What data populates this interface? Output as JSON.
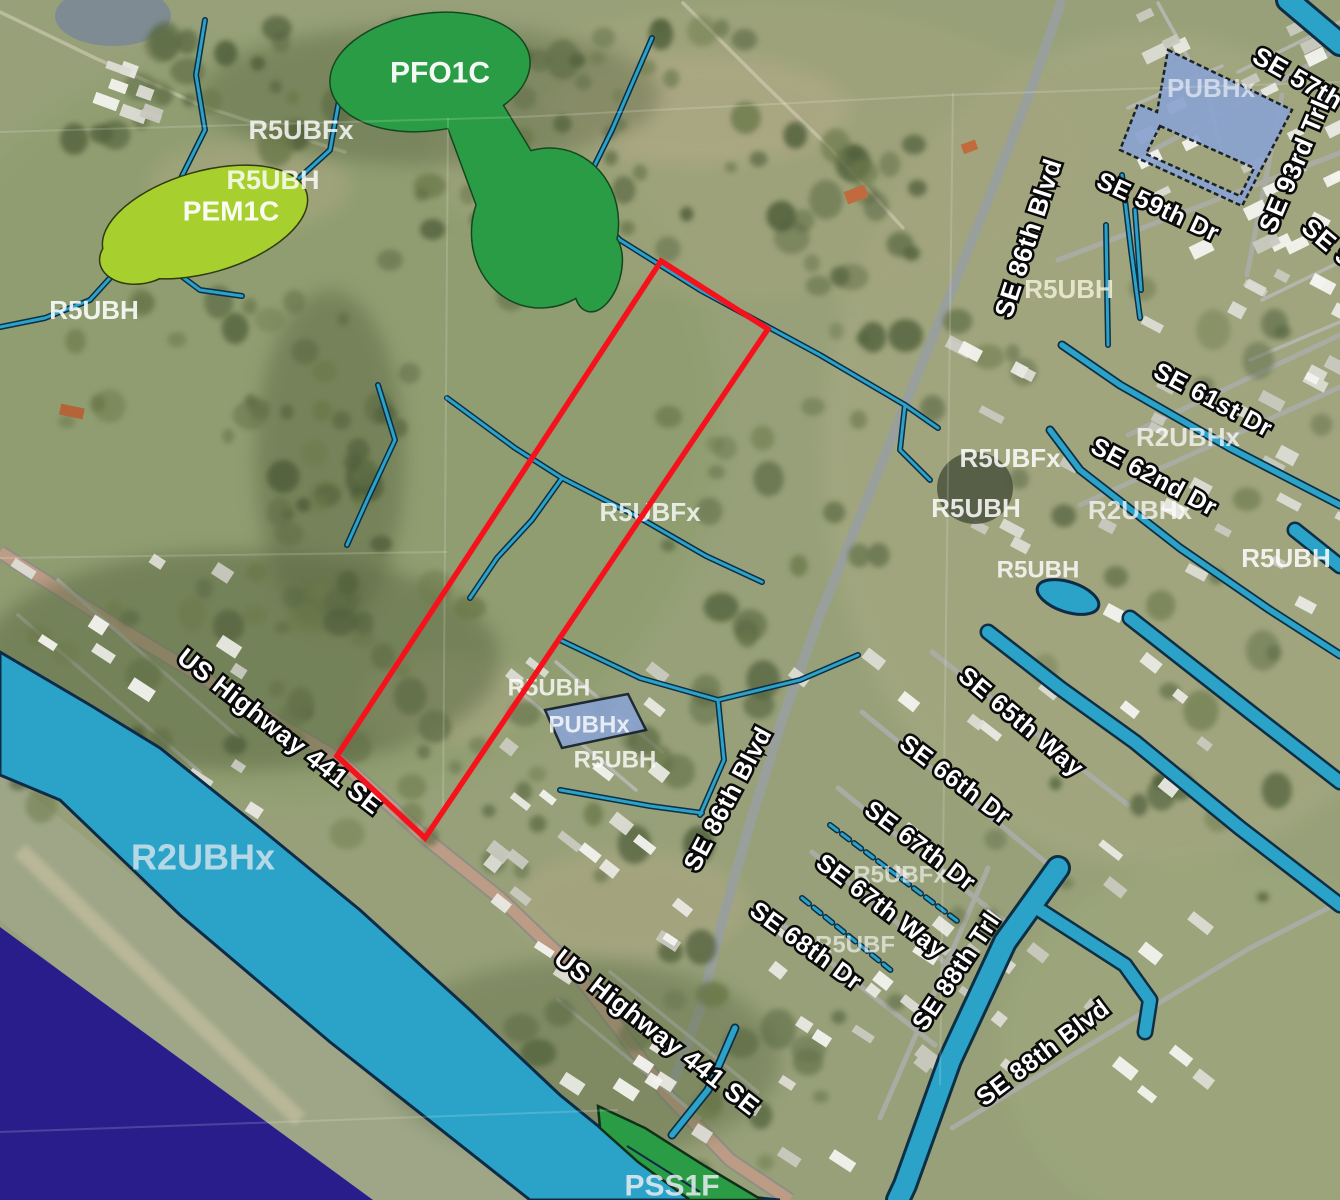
{
  "map": {
    "type": "wetlands-inventory-aerial-map",
    "parcel_outline": {
      "color": "#f5121d",
      "points": [
        [
          661,
          261
        ],
        [
          768,
          329
        ],
        [
          425,
          838
        ],
        [
          337,
          756
        ]
      ]
    },
    "colors": {
      "forested_wetland_green": "#2b9c46",
      "emergent_wetland_green": "#a7d02f",
      "pond_overlay_blue": "#8ba3d0",
      "canal_teal": "#2ba2c8",
      "lake_purple": "#291d8c",
      "parcel_red": "#f5121d"
    },
    "labels": [
      {
        "kind": "wetland",
        "text": "PFO1C",
        "x": 440,
        "y": 73,
        "size": 30,
        "rot": 0,
        "opacity": 0.95,
        "fill": "#ffffff"
      },
      {
        "kind": "wetland",
        "text": "R5UBFx",
        "x": 301,
        "y": 130,
        "size": 27,
        "rot": 0,
        "opacity": 0.82,
        "fill": "#ffffff"
      },
      {
        "kind": "wetland",
        "text": "R5UBH",
        "x": 273,
        "y": 180,
        "size": 27,
        "rot": 0,
        "opacity": 0.82,
        "fill": "#ffffff"
      },
      {
        "kind": "wetland",
        "text": "PEM1C",
        "x": 231,
        "y": 211,
        "size": 28,
        "rot": 0,
        "opacity": 0.95,
        "fill": "#ffffff"
      },
      {
        "kind": "wetland",
        "text": "R5UBH",
        "x": 94,
        "y": 310,
        "size": 26,
        "rot": 0,
        "opacity": 0.88,
        "fill": "#ffffff"
      },
      {
        "kind": "wetland",
        "text": "R5UBFx",
        "x": 650,
        "y": 512,
        "size": 26,
        "rot": 0,
        "opacity": 0.8,
        "fill": "#ffffff"
      },
      {
        "kind": "wetland",
        "text": "R5UBH",
        "x": 549,
        "y": 688,
        "size": 24,
        "rot": 0,
        "opacity": 0.8,
        "fill": "#ffffff"
      },
      {
        "kind": "wetland",
        "text": "PUBHx",
        "x": 589,
        "y": 725,
        "size": 24,
        "rot": 0,
        "opacity": 0.8,
        "fill": "#ffffff"
      },
      {
        "kind": "wetland",
        "text": "R5UBH",
        "x": 615,
        "y": 760,
        "size": 24,
        "rot": 0,
        "opacity": 0.8,
        "fill": "#ffffff"
      },
      {
        "kind": "wetland",
        "text": "R2UBHx",
        "x": 203,
        "y": 857,
        "size": 36,
        "rot": 0,
        "opacity": 0.8,
        "fill": "#d8e6ef"
      },
      {
        "kind": "wetland",
        "text": "PSS1F",
        "x": 672,
        "y": 1186,
        "size": 30,
        "rot": 0,
        "opacity": 0.85,
        "fill": "#e8eef2"
      },
      {
        "kind": "wetland",
        "text": "PUBHx",
        "x": 1211,
        "y": 88,
        "size": 26,
        "rot": 0,
        "opacity": 0.7,
        "fill": "#e9eef6"
      },
      {
        "kind": "wetland",
        "text": "R5UBH",
        "x": 1069,
        "y": 289,
        "size": 26,
        "rot": 0,
        "opacity": 0.82,
        "fill": "#f4f2dd"
      },
      {
        "kind": "wetland",
        "text": "R5UBFx",
        "x": 1010,
        "y": 458,
        "size": 26,
        "rot": 0,
        "opacity": 0.85,
        "fill": "#ffffff"
      },
      {
        "kind": "wetland",
        "text": "R5UBH",
        "x": 976,
        "y": 508,
        "size": 26,
        "rot": 0,
        "opacity": 0.85,
        "fill": "#ffffff"
      },
      {
        "kind": "wetland",
        "text": "R2UBHx",
        "x": 1188,
        "y": 437,
        "size": 26,
        "rot": 0,
        "opacity": 0.72,
        "fill": "#ffffff"
      },
      {
        "kind": "wetland",
        "text": "R2UBHx",
        "x": 1140,
        "y": 510,
        "size": 26,
        "rot": 0,
        "opacity": 0.72,
        "fill": "#ffffff"
      },
      {
        "kind": "wetland",
        "text": "R5UBH",
        "x": 1286,
        "y": 558,
        "size": 26,
        "rot": 0,
        "opacity": 0.85,
        "fill": "#ffffff"
      },
      {
        "kind": "wetland",
        "text": "R5UBH",
        "x": 1038,
        "y": 570,
        "size": 24,
        "rot": 0,
        "opacity": 0.82,
        "fill": "#ffffff"
      },
      {
        "kind": "wetland",
        "text": "R5UBFx",
        "x": 900,
        "y": 875,
        "size": 24,
        "rot": 0,
        "opacity": 0.6,
        "fill": "#ffffff"
      },
      {
        "kind": "wetland",
        "text": "R5UBF",
        "x": 855,
        "y": 945,
        "size": 24,
        "rot": 0,
        "opacity": 0.6,
        "fill": "#ffffff"
      },
      {
        "kind": "street",
        "text": "SE 57th",
        "x": 1298,
        "y": 78,
        "size": 26,
        "rot": 30
      },
      {
        "kind": "street",
        "text": "SE 93rd Trl",
        "x": 1294,
        "y": 166,
        "size": 26,
        "rot": -67
      },
      {
        "kind": "street",
        "text": "SE 59th Dr",
        "x": 1158,
        "y": 207,
        "size": 25,
        "rot": 25
      },
      {
        "kind": "street",
        "text": "SE 86th Blvd",
        "x": 1028,
        "y": 238,
        "size": 26,
        "rot": -72
      },
      {
        "kind": "street",
        "text": "SE 9",
        "x": 1328,
        "y": 242,
        "size": 26,
        "rot": 40
      },
      {
        "kind": "street",
        "text": "SE 61st Dr",
        "x": 1213,
        "y": 400,
        "size": 25,
        "rot": 28
      },
      {
        "kind": "street",
        "text": "SE 62nd Dr",
        "x": 1154,
        "y": 477,
        "size": 25,
        "rot": 28
      },
      {
        "kind": "street",
        "text": "SE 65th Way",
        "x": 1021,
        "y": 722,
        "size": 25,
        "rot": 40
      },
      {
        "kind": "street",
        "text": "SE 66th Dr",
        "x": 955,
        "y": 780,
        "size": 25,
        "rot": 37
      },
      {
        "kind": "street",
        "text": "SE 67th Dr",
        "x": 920,
        "y": 846,
        "size": 25,
        "rot": 37
      },
      {
        "kind": "street",
        "text": "SE 67th Way",
        "x": 881,
        "y": 906,
        "size": 25,
        "rot": 37
      },
      {
        "kind": "street",
        "text": "SE 68th Dr",
        "x": 806,
        "y": 946,
        "size": 25,
        "rot": 36
      },
      {
        "kind": "street",
        "text": "SE 88th Trl",
        "x": 956,
        "y": 972,
        "size": 25,
        "rot": -56
      },
      {
        "kind": "street",
        "text": "SE 88th Blvd",
        "x": 1043,
        "y": 1053,
        "size": 25,
        "rot": -37
      },
      {
        "kind": "street",
        "text": "US Highway 441 SE",
        "x": 280,
        "y": 731,
        "size": 26,
        "rot": 38
      },
      {
        "kind": "street",
        "text": "US Highway 441 SE",
        "x": 657,
        "y": 1032,
        "size": 26,
        "rot": 38
      },
      {
        "kind": "street",
        "text": "SE 86th Blvd",
        "x": 728,
        "y": 799,
        "size": 25,
        "rot": -62
      }
    ]
  }
}
